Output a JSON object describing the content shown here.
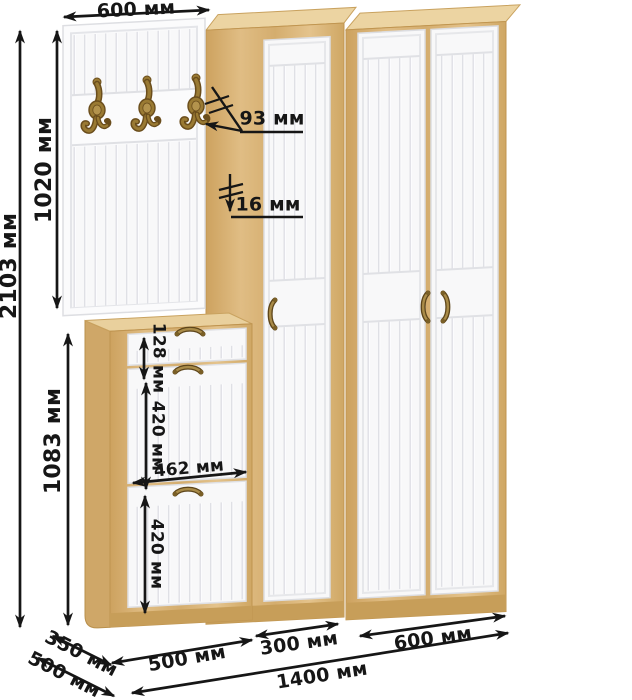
{
  "units": "мм",
  "labels": {
    "total_height": "2103 мм",
    "panel_height": "1020 мм",
    "panel_width": "600 мм",
    "hook_depth": "93 мм",
    "panel_thickness": "16 мм",
    "cabinet_height": "1083 мм",
    "drawer_height": "128 мм",
    "upper_flap_height": "420 мм",
    "flap_width": "462 мм",
    "lower_flap_height": "420 мм",
    "cabinet_width": "500 мм",
    "narrow_wardrobe_width": "300 мм",
    "wide_wardrobe_width": "600 мм",
    "total_width": "1400 мм",
    "cabinet_depth": "350 мм",
    "wardrobe_depth": "500 мм"
  },
  "scene": {
    "pieces": [
      "coat-hook-panel",
      "shoe-cabinet",
      "narrow-wardrobe",
      "wide-wardrobe"
    ],
    "hook_count": 3,
    "wide_wardrobe_doors": 2,
    "shoe_cabinet_fronts": 3
  },
  "colors": {
    "background": "#ffffff",
    "oak": "#d9b478",
    "oak_light": "#ead1a0",
    "oak_dark": "#c79e59",
    "door_white": "#f8f8f9",
    "groove": "#dfe0e5",
    "dimension": "#161616",
    "brass": "#8f7130"
  }
}
